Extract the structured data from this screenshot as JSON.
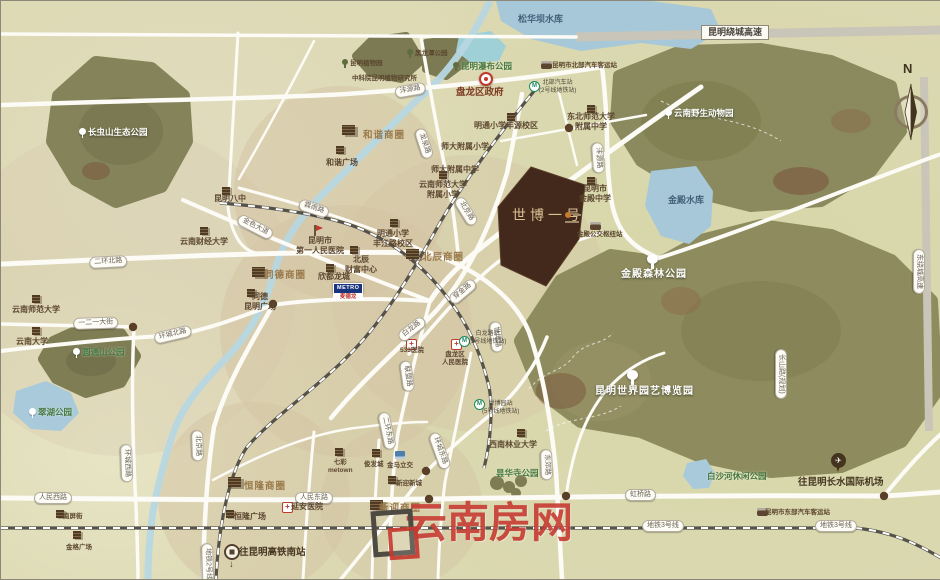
{
  "colors": {
    "project_fill": "#42291b",
    "watermark_red": "#c5352c",
    "water": "#a6c8d8",
    "forest": "#8b8a5f",
    "road_white": "#fcfbf5",
    "highway_gray": "#c9c5b8",
    "metro_green": "#1e8a60",
    "hospital_red": "#bf3a2b",
    "district_brown": "#9a7a4c"
  },
  "labels": [
    {
      "n": "songhuaba-reservoir-label",
      "t": "松华坝水库",
      "x": 517,
      "y": 13,
      "c": "water"
    },
    {
      "n": "raocheng-expressway-label",
      "t": "昆明绕城高速",
      "x": 700,
      "y": 24,
      "c": "pillhw"
    },
    {
      "n": "east-raocheng-expressway-label",
      "t": "东绕城高速",
      "x": 924,
      "y": 248,
      "c": "pill",
      "r": 90
    },
    {
      "n": "changchongshan-eco-park-label",
      "t": "长虫山生态公园",
      "x": 78,
      "y": 126,
      "c": "parkw",
      "i": "treew"
    },
    {
      "n": "kunming-botanical-garden-label",
      "t": "昆明植物园",
      "x": 341,
      "y": 58,
      "c": "poixs",
      "i": "treed"
    },
    {
      "n": "heilongtan-park-label",
      "t": "黑龙潭公园",
      "x": 406,
      "y": 48,
      "c": "poixs",
      "i": "treed"
    },
    {
      "n": "cas-botany-institute-label",
      "t": "中科院昆明植物研究所",
      "x": 351,
      "y": 74,
      "c": "poixs"
    },
    {
      "n": "waterfall-park-label",
      "t": "昆明瀑布公园",
      "x": 452,
      "y": 60,
      "c": "parkg",
      "i": "treed"
    },
    {
      "n": "wildlife-park-label",
      "t": "云南野生动物园",
      "x": 664,
      "y": 107,
      "c": "parkw",
      "i": "treew"
    },
    {
      "n": "panlong-district-government-label",
      "t": "盘龙区政府",
      "x": 455,
      "y": 86,
      "c": "gov"
    },
    {
      "n": "north-bus-terminal-label",
      "t": "昆明市北部汽车客运站",
      "x": 551,
      "y": 61,
      "c": "poixs"
    },
    {
      "n": "north-bus-metro-station-label",
      "t": "北部汽车站",
      "t2": "(2号线地铁站)",
      "x": 538,
      "y": 79,
      "c": "station"
    },
    {
      "n": "fengyuan-road-pill-west",
      "t": "沣源路",
      "x": 393,
      "y": 86,
      "c": "pill",
      "r": -10
    },
    {
      "n": "fengyuan-road-pill-north",
      "t": "沣源路",
      "x": 602,
      "y": 141,
      "c": "pill",
      "r": 86
    },
    {
      "n": "longquan-road-pill",
      "t": "龙泉路",
      "x": 424,
      "y": 126,
      "c": "pill",
      "r": 72
    },
    {
      "n": "dongbei-normal-attached-middle-label",
      "t": "东北师范大学",
      "t2": "附属中学",
      "x": 566,
      "y": 111,
      "c": "poi2"
    },
    {
      "n": "mingtong-primary-fengyuan-label",
      "t": "明通小学丰源校区",
      "x": 473,
      "y": 120,
      "c": "poi"
    },
    {
      "n": "shida-attached-primary-label",
      "t": "师大附属小学",
      "x": 440,
      "y": 141,
      "c": "poi"
    },
    {
      "n": "shida-attached-middle-label",
      "t": "师大附属中学",
      "x": 430,
      "y": 164,
      "c": "poi"
    },
    {
      "n": "kunming-no8-middle-school-label",
      "t": "昆明八中",
      "x": 213,
      "y": 193,
      "c": "poi"
    },
    {
      "n": "hexie-business-district-label",
      "t": "和谐商圈",
      "x": 362,
      "y": 129,
      "c": "district"
    },
    {
      "n": "hexie-plaza-label",
      "t": "和谐广场",
      "x": 325,
      "y": 157,
      "c": "poi"
    },
    {
      "n": "yunnan-finance-university-label",
      "t": "云南财经大学",
      "x": 179,
      "y": 236,
      "c": "poi"
    },
    {
      "n": "jinse-avenue-pill",
      "t": "金色大道",
      "x": 240,
      "y": 212,
      "c": "pill",
      "r": 27
    },
    {
      "n": "linyu-road-pill",
      "t": "霖雨路",
      "x": 300,
      "y": 197,
      "c": "pill",
      "r": 18
    },
    {
      "n": "first-peoples-hospital-label",
      "t": "昆明市",
      "t2": "第一人民医院",
      "x": 295,
      "y": 235,
      "c": "poi2"
    },
    {
      "n": "mingtong-primary-fengjiang-label",
      "t": "明通小学",
      "t2": "丰江路校区",
      "x": 372,
      "y": 228,
      "c": "poi2"
    },
    {
      "n": "ynnu-attached-primary-label",
      "t": "云南师范大学",
      "t2": "附属小学",
      "x": 418,
      "y": 179,
      "c": "poi2"
    },
    {
      "n": "beijing-road-pill-north",
      "t": "北京路",
      "x": 462,
      "y": 194,
      "c": "pill",
      "r": 58
    },
    {
      "n": "erhuan-north-road-pill",
      "t": "二环北路",
      "x": 88,
      "y": 256,
      "c": "pill",
      "r": -3
    },
    {
      "n": "yunnan-normal-university-label",
      "t": "云南师范大学",
      "x": 11,
      "y": 304,
      "c": "poi"
    },
    {
      "n": "yiereyi-street-pill",
      "t": "一二一大街",
      "x": 72,
      "y": 317,
      "c": "pill",
      "r": -2
    },
    {
      "n": "yunnan-university-label",
      "t": "云南大学",
      "x": 15,
      "y": 336,
      "c": "poi"
    },
    {
      "n": "yuantongshan-park-label",
      "t": "圆通山公园",
      "x": 72,
      "y": 346,
      "c": "parkg",
      "i": "treew"
    },
    {
      "n": "huancheng-north-road-pill",
      "t": "环城北路",
      "x": 152,
      "y": 332,
      "c": "pill",
      "r": -13
    },
    {
      "n": "cuihu-park-label",
      "t": "翠湖公园",
      "x": 28,
      "y": 406,
      "c": "parkg",
      "i": "treew"
    },
    {
      "n": "tongde-business-district-label",
      "t": "同德商圈",
      "x": 263,
      "y": 269,
      "c": "district"
    },
    {
      "n": "tongde-kunming-plaza-label",
      "t": "同德",
      "t2": "昆明广场",
      "x": 243,
      "y": 291,
      "c": "poi2"
    },
    {
      "n": "beichen-fortune-center-label",
      "t": "北辰",
      "t2": "财富中心",
      "x": 344,
      "y": 254,
      "c": "poi2"
    },
    {
      "n": "xindu-longcheng-label",
      "t": "欣都龙城",
      "x": 317,
      "y": 271,
      "c": "poi"
    },
    {
      "n": "metro-supermarket-sign",
      "t": "METRO",
      "t2": "麦德龙",
      "x": 332,
      "y": 282,
      "c": "metrosign"
    },
    {
      "n": "beichen-business-district-label",
      "t": "北辰商圈",
      "x": 421,
      "y": 251,
      "c": "district"
    },
    {
      "n": "chuanjin-road-pill",
      "t": "穿金路",
      "x": 446,
      "y": 296,
      "c": "pill",
      "r": -40
    },
    {
      "n": "bailong-road-pill",
      "t": "白龙路",
      "x": 395,
      "y": 333,
      "c": "pill",
      "r": -38
    },
    {
      "n": "shibo-road-pill",
      "t": "世博路",
      "x": 500,
      "y": 320,
      "c": "pill",
      "r": 85
    },
    {
      "n": "lianmeng-road-pill",
      "t": "联盟路",
      "x": 410,
      "y": 359,
      "c": "pill",
      "r": 82
    },
    {
      "n": "hospital-533-label",
      "t": "533医院",
      "x": 399,
      "y": 346,
      "c": "poixs"
    },
    {
      "n": "panlong-peoples-hospital-label",
      "t": "盘龙区",
      "t2": "人民医院",
      "x": 441,
      "y": 350,
      "c": "poi2xs"
    },
    {
      "n": "bailong-metro-station-label",
      "t": "白龙路站",
      "t2": "(5号线地铁站)",
      "x": 468,
      "y": 330,
      "c": "station"
    },
    {
      "n": "shibo-yihao-project-label",
      "t": "世博一号",
      "x": 511,
      "y": 207,
      "c": "proj"
    },
    {
      "n": "jindian-middle-school-label",
      "t": "昆明市",
      "t2": "金殿中学",
      "x": 578,
      "y": 183,
      "c": "poi2"
    },
    {
      "n": "jindian-bus-hub-label",
      "t": "金殿公交枢纽站",
      "x": 576,
      "y": 230,
      "c": "poixs"
    },
    {
      "n": "jindian-forest-park-label",
      "t": "金殿森林公园",
      "x": 620,
      "y": 268,
      "c": "parkw2"
    },
    {
      "n": "expo-garden-label",
      "t": "昆明世界园艺博览园",
      "x": 594,
      "y": 385,
      "c": "parkw2"
    },
    {
      "n": "jindian-reservoir-label",
      "t": "金殿水库",
      "x": 667,
      "y": 194,
      "c": "water"
    },
    {
      "n": "erhuan-east-road-pill",
      "t": "二环东路",
      "x": 388,
      "y": 410,
      "c": "pill",
      "r": 78
    },
    {
      "n": "huancheng-east-road-pill",
      "t": "环城东路",
      "x": 438,
      "y": 430,
      "c": "pill",
      "r": 70
    },
    {
      "n": "expo-metro-station-label",
      "t": "世博园站",
      "t2": "(5号线地铁站)",
      "x": 481,
      "y": 400,
      "c": "station"
    },
    {
      "n": "southwest-forestry-university-label",
      "t": "西南林业大学",
      "x": 488,
      "y": 439,
      "c": "poi"
    },
    {
      "n": "tanhuasi-park-label",
      "t": "昙华寺公园",
      "x": 495,
      "y": 467,
      "c": "parkg"
    },
    {
      "n": "dongjiao-road-pill",
      "t": "东郊路",
      "x": 551,
      "y": 448,
      "c": "pill",
      "r": 88
    },
    {
      "n": "hongqiao-road-pill",
      "t": "虹桥路",
      "x": 624,
      "y": 488,
      "c": "pill"
    },
    {
      "n": "metro-line3-pill-west",
      "t": "地铁3号线",
      "x": 641,
      "y": 519,
      "c": "pill"
    },
    {
      "n": "metro-line3-pill-east",
      "t": "地铁3号线",
      "x": 814,
      "y": 519,
      "c": "pill"
    },
    {
      "n": "baishahe-park-label",
      "t": "白沙河休闲公园",
      "x": 706,
      "y": 470,
      "c": "parkg"
    },
    {
      "n": "airport-direction-label",
      "t": "往昆明长水国际机场",
      "x": 797,
      "y": 476,
      "c": "dir"
    },
    {
      "n": "east-bus-terminal-label",
      "t": "昆明市东部汽车客运站",
      "x": 764,
      "y": 508,
      "c": "poixs"
    },
    {
      "n": "changshan-road-pill",
      "t": "长山路(规划)",
      "x": 786,
      "y": 348,
      "c": "pill",
      "r": 90
    },
    {
      "n": "beijing-road-pill-south",
      "t": "北京路",
      "x": 202,
      "y": 429,
      "c": "pill",
      "r": 88
    },
    {
      "n": "henglong-business-district-label",
      "t": "恒隆商圈",
      "x": 243,
      "y": 480,
      "c": "district"
    },
    {
      "n": "renmin-east-road-pill",
      "t": "人民东路",
      "x": 294,
      "y": 491,
      "c": "pill"
    },
    {
      "n": "yanan-hospital-label",
      "t": "延安医院",
      "x": 290,
      "y": 501,
      "c": "poi"
    },
    {
      "n": "henglong-plaza-label",
      "t": "恒隆广场",
      "x": 233,
      "y": 511,
      "c": "poi"
    },
    {
      "n": "qicai-metown-label",
      "t": "七彩",
      "t2": "metown",
      "x": 327,
      "y": 458,
      "c": "poi2xs"
    },
    {
      "n": "junfacheng-label",
      "t": "俊发城",
      "x": 363,
      "y": 460,
      "c": "poixs"
    },
    {
      "n": "jinma-interchange-label",
      "t": "金马立交",
      "x": 386,
      "y": 461,
      "c": "poixs"
    },
    {
      "n": "xinying-newtown-label",
      "t": "新迎新城",
      "x": 395,
      "y": 479,
      "c": "poixs"
    },
    {
      "n": "xinying-business-district-label",
      "t": "新迎商圈",
      "x": 378,
      "y": 502,
      "c": "district"
    },
    {
      "n": "renmin-west-road-pill",
      "t": "人民西路",
      "x": 33,
      "y": 491,
      "c": "pill"
    },
    {
      "n": "huancheng-west-road-pill",
      "t": "环城西路",
      "x": 131,
      "y": 443,
      "c": "pill",
      "r": 88
    },
    {
      "n": "nanping-street-label",
      "t": "南屏街",
      "x": 62,
      "y": 512,
      "c": "poixs"
    },
    {
      "n": "jinge-plaza-label",
      "t": "金格广场",
      "x": 65,
      "y": 543,
      "c": "poixs"
    },
    {
      "n": "metro-line2-pill",
      "t": "地铁2号线",
      "x": 212,
      "y": 542,
      "c": "pill",
      "r": 88
    },
    {
      "n": "south-railway-direction-label",
      "t": "往昆明高铁南站",
      "x": 238,
      "y": 546,
      "c": "dir"
    },
    {
      "n": "south-direction-arrow",
      "t": "↓",
      "x": 228,
      "y": 558,
      "c": "dir"
    },
    {
      "n": "watermark-text",
      "t": "云南房网",
      "x": 404,
      "y": 497,
      "c": "wm"
    },
    {
      "n": "compass-north-label",
      "t": "N",
      "x": 902,
      "y": 60,
      "c": "north"
    }
  ],
  "icons": [
    {
      "n": "government-marker-icon",
      "i": "gov",
      "x": 478,
      "y": 71
    },
    {
      "n": "bus-station-icon",
      "i": "bus",
      "x": 540,
      "y": 60
    },
    {
      "n": "metro-station-icon",
      "i": "metro",
      "x": 528,
      "y": 80
    },
    {
      "n": "school-icon",
      "i": "bld",
      "x": 506,
      "y": 112
    },
    {
      "n": "school-icon",
      "i": "bld",
      "x": 586,
      "y": 104
    },
    {
      "n": "school-icon",
      "i": "bld",
      "x": 221,
      "y": 186
    },
    {
      "n": "mall-cluster-icon",
      "i": "bldlg",
      "x": 341,
      "y": 124
    },
    {
      "n": "mall-icon",
      "i": "bld",
      "x": 335,
      "y": 145
    },
    {
      "n": "school-icon",
      "i": "bld",
      "x": 199,
      "y": 226
    },
    {
      "n": "hospital-flag-icon",
      "i": "flag",
      "x": 313,
      "y": 224
    },
    {
      "n": "school-icon",
      "i": "bld",
      "x": 389,
      "y": 218
    },
    {
      "n": "school-icon",
      "i": "bld",
      "x": 438,
      "y": 170
    },
    {
      "n": "mall-cluster-icon",
      "i": "bldlg",
      "x": 405,
      "y": 248
    },
    {
      "n": "mall-icon",
      "i": "bld",
      "x": 349,
      "y": 245
    },
    {
      "n": "mall-icon",
      "i": "bld",
      "x": 325,
      "y": 263
    },
    {
      "n": "mall-cluster-icon",
      "i": "bldlg",
      "x": 251,
      "y": 266
    },
    {
      "n": "mall-icon",
      "i": "bld",
      "x": 246,
      "y": 288
    },
    {
      "n": "school-icon",
      "i": "bld",
      "x": 31,
      "y": 294
    },
    {
      "n": "school-icon",
      "i": "bld",
      "x": 31,
      "y": 326
    },
    {
      "n": "hospital-cross-icon",
      "i": "cross",
      "x": 405,
      "y": 338
    },
    {
      "n": "hospital-cross-icon",
      "i": "cross",
      "x": 450,
      "y": 338
    },
    {
      "n": "metro-station-icon",
      "i": "metro",
      "x": 458,
      "y": 335
    },
    {
      "n": "school-icon",
      "i": "bld",
      "x": 586,
      "y": 176
    },
    {
      "n": "bus-station-icon",
      "i": "bus",
      "x": 589,
      "y": 221
    },
    {
      "n": "tree-icon",
      "i": "treew2",
      "x": 646,
      "y": 253
    },
    {
      "n": "tree-icon",
      "i": "treew2",
      "x": 626,
      "y": 369
    },
    {
      "n": "metro-station-icon",
      "i": "metro",
      "x": 473,
      "y": 398
    },
    {
      "n": "school-icon",
      "i": "bld",
      "x": 516,
      "y": 428
    },
    {
      "n": "mall-cluster-icon",
      "i": "bldlg",
      "x": 227,
      "y": 476
    },
    {
      "n": "hospital-cross-icon",
      "i": "cross",
      "x": 281,
      "y": 501
    },
    {
      "n": "mall-icon",
      "i": "bld",
      "x": 225,
      "y": 509
    },
    {
      "n": "mall-icon",
      "i": "bld",
      "x": 334,
      "y": 447
    },
    {
      "n": "mall-icon",
      "i": "bld",
      "x": 371,
      "y": 448
    },
    {
      "n": "interchange-icon",
      "i": "blue",
      "x": 394,
      "y": 450
    },
    {
      "n": "mall-icon",
      "i": "bld",
      "x": 387,
      "y": 475
    },
    {
      "n": "mall-cluster-icon",
      "i": "bldlg",
      "x": 369,
      "y": 499
    },
    {
      "n": "mall-icon",
      "i": "bld",
      "x": 55,
      "y": 509
    },
    {
      "n": "mall-icon",
      "i": "bld",
      "x": 72,
      "y": 530
    },
    {
      "n": "railway-station-icon",
      "i": "railc",
      "x": 223,
      "y": 543
    },
    {
      "n": "bus-station-icon",
      "i": "bus",
      "x": 756,
      "y": 507
    },
    {
      "n": "airport-pin-icon",
      "i": "pin",
      "x": 830,
      "y": 452
    }
  ]
}
